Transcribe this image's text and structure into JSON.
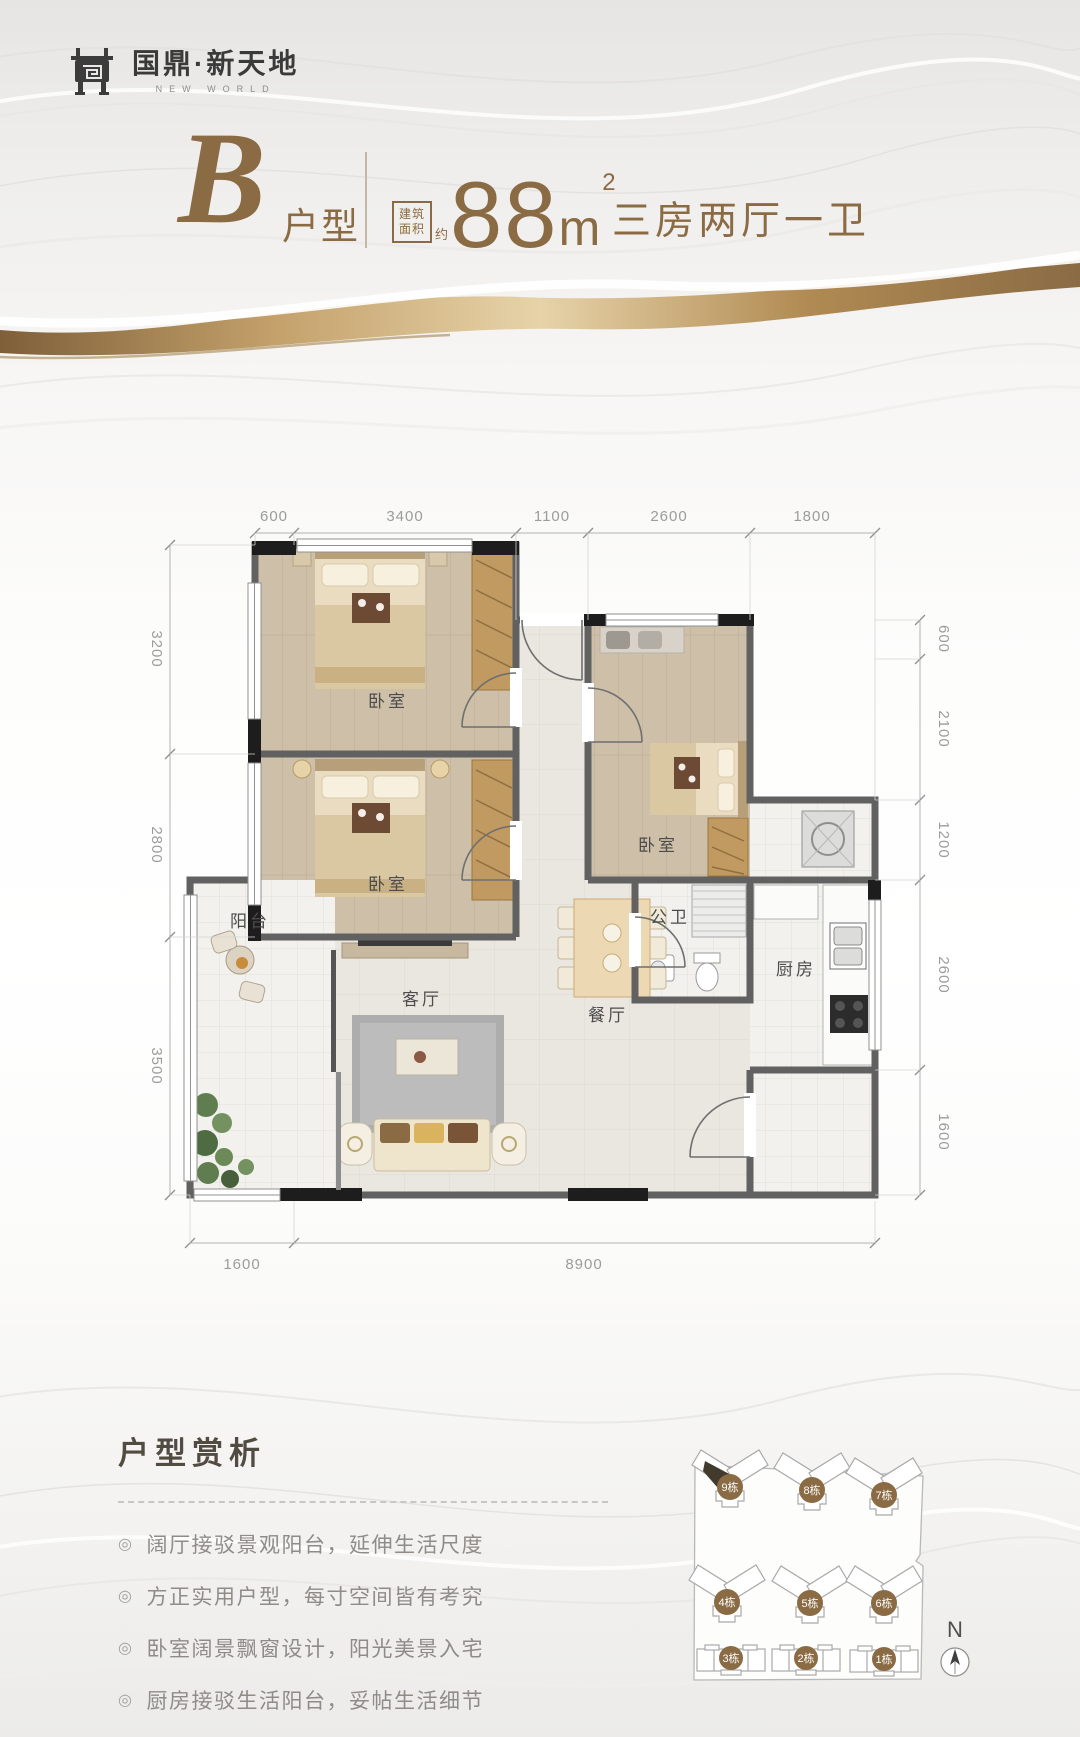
{
  "brand": {
    "name": "国鼎·新天地",
    "name_en": "NEW WORLD"
  },
  "header": {
    "unit_letter": "B",
    "unit_label": "户型",
    "area_box_line1": "建筑",
    "area_box_line2": "面积",
    "area_approx": "约",
    "area_value": "88",
    "area_unit": "m",
    "area_exponent": "2",
    "layout_summary": "三房两厅一卫"
  },
  "floorplan": {
    "rooms": {
      "bedroom_master": "卧室",
      "bedroom_second": "卧室",
      "bedroom_third": "卧室",
      "bathroom": "公卫",
      "balcony": "阳台",
      "living_room": "客厅",
      "dining_room": "餐厅",
      "kitchen": "厨房"
    },
    "dims_top": [
      "600",
      "3400",
      "1100",
      "2600",
      "1800"
    ],
    "dims_left": [
      "3200",
      "2800",
      "3500"
    ],
    "dims_right": [
      "600",
      "2100",
      "1200",
      "2600",
      "1600"
    ],
    "dims_bottom": [
      "1600",
      "8900"
    ]
  },
  "analysis": {
    "title": "户型赏析",
    "marker": "◎",
    "bullets": [
      "阔厅接驳景观阳台，延伸生活尺度",
      "方正实用户型，每寸空间皆有考究",
      "卧室阔景飘窗设计，阳光美景入宅",
      "厨房接驳生活阳台，妥帖生活细节"
    ]
  },
  "siteplan": {
    "buildings": [
      "9栋",
      "8栋",
      "7栋",
      "4栋",
      "5栋",
      "6栋",
      "3栋",
      "2栋",
      "1栋"
    ],
    "compass_label": "N"
  },
  "colors": {
    "accent": "#8a6b44",
    "wall": "#616161",
    "dim_text": "#9c9c9c"
  }
}
